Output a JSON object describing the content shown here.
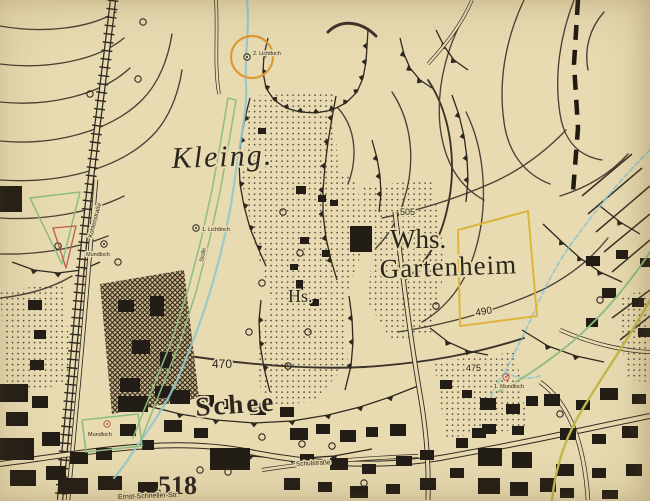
{
  "map": {
    "place_labels": {
      "kleingarten": "Kleing.",
      "whs": "Whs.",
      "gartenheim": "Gartenheim",
      "haus_abbr": "Hs.",
      "schee": "Schee",
      "elevation_518": "518"
    },
    "contour_labels": {
      "c505": "505",
      "c490": "490",
      "c470": "470",
      "c475": "475"
    },
    "street_labels": {
      "schulstrasse": "Schulstraße",
      "ernst_schneller_str": "Ernst-Schneller-Str.",
      "kohlenstrasse": "Kohlenstraße"
    },
    "mine_labels": {
      "lichtloch_2": "2. Lichtloch",
      "lichtloch_1": "1. Lichtloch",
      "mundloch_1": "1. Mundloch",
      "mundloch_left": "Mundloch",
      "mundloch_lower": "Mundloch",
      "stolln": "Stolln"
    }
  },
  "colors": {
    "paper": "#e8dbb2",
    "ink": "#2e2920",
    "contour": "#4a4036",
    "overlay_cyan": "#93c7cc",
    "overlay_green": "#8dbd82",
    "overlay_orange": "#dd9a33",
    "overlay_yellow": "#ddb43c",
    "overlay_red": "#c05a50",
    "overlay_olive": "#c3b84a"
  }
}
